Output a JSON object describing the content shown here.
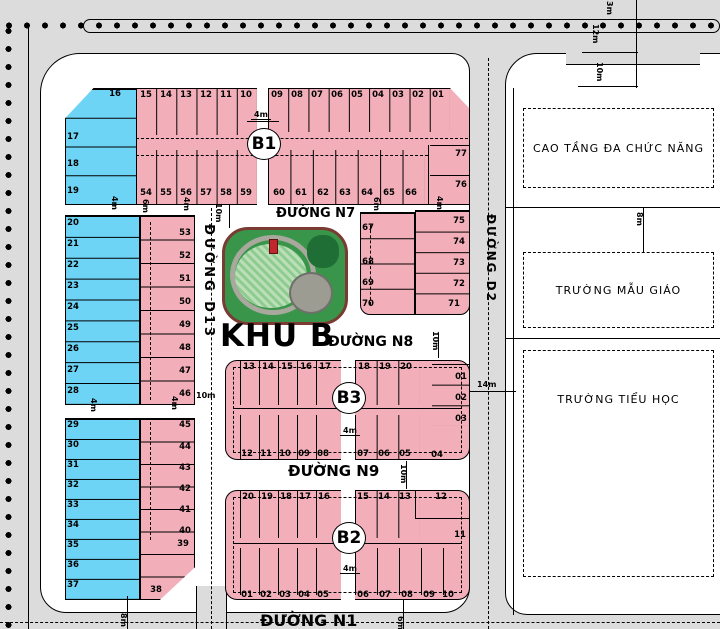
{
  "plan_title": "KHU B",
  "street_labels": {
    "n7": "ĐƯỜNG N7",
    "n8": "ĐƯỜNG N8",
    "n9": "ĐƯỜNG N9",
    "n1": "ĐƯỜNG N1",
    "d13": "ĐƯỜNG D13",
    "d2": "ĐƯỜNG D2"
  },
  "block_labels": {
    "b1": "B1",
    "b3": "B3",
    "b2": "B2"
  },
  "facility_labels": {
    "cao_tang": "CAO TẦNG ĐA CHỨC NĂNG",
    "mau_giao": "TRƯỜNG MẪU GIÁO",
    "tieu_hoc": "TRƯỜNG TIỂU HỌC"
  },
  "plan": {
    "colors": {
      "background": "#dcdcdc",
      "street_white": "#ffffff",
      "lot_pink": "#f2afba",
      "lot_blue": "#6dd4f5",
      "line": "#000000",
      "park_green": "#38954a",
      "park_border": "#7a3b32",
      "lawn_light": "#badfb8",
      "lawn_mid": "#8ecb8f",
      "plaza_gray": "#9c9c93",
      "tree_green": "#1f6e35",
      "kiosk_red": "#c1272d"
    },
    "lot_groups": [
      [
        "blue-top",
        65,
        88,
        75,
        117,
        "lot_blue",
        "v",
        4,
        {
          "border": 1,
          "clip": "polygon(0 26%, 38% 0, 100% 0, 100% 100%, 0 100%)"
        }
      ],
      [
        "b1-bg",
        136,
        88,
        334,
        117,
        "lot_pink",
        null,
        0,
        {
          "border": 1,
          "clip": "polygon(0 0, 94% 0, 100% 18%, 100% 100%, 0 100%)"
        }
      ],
      [
        "b1-strip-tl",
        136,
        88,
        121,
        47,
        null,
        "h",
        6,
        null
      ],
      [
        "b1-strip-tr",
        268,
        88,
        182,
        44,
        null,
        "h",
        9,
        null
      ],
      [
        "b1-strip-bl",
        136,
        150,
        121,
        55,
        null,
        "h",
        6,
        null
      ],
      [
        "b1-strip-br",
        268,
        150,
        157,
        55,
        null,
        "h",
        7,
        null
      ],
      [
        "b1-col-r",
        430,
        145,
        40,
        60,
        null,
        "v",
        2,
        null
      ],
      [
        "b1-alley",
        257,
        88,
        11,
        117,
        "street_white",
        null,
        0,
        null
      ],
      [
        "leftmid-blue",
        65,
        215,
        75,
        190,
        "lot_blue",
        "v",
        9,
        {
          "border": 1
        }
      ],
      [
        "leftmid-pink",
        140,
        215,
        55,
        190,
        "lot_pink",
        "v",
        8,
        {
          "border": 1
        }
      ],
      [
        "leftbot-blue",
        65,
        418,
        75,
        182,
        "lot_blue",
        "v",
        9,
        {
          "border": 1
        }
      ],
      [
        "leftbot-pink",
        140,
        418,
        55,
        182,
        "lot_pink",
        "v",
        8,
        {
          "border": 1,
          "clip": "polygon(0 0, 100% 0, 100% 82%, 36% 100%, 0 100%)"
        }
      ],
      [
        "parke-left",
        360,
        212,
        55,
        103,
        "lot_pink",
        "v",
        4,
        {
          "border": 1,
          "radius": "0 0 0 10px"
        }
      ],
      [
        "parke-right",
        415,
        210,
        55,
        105,
        "lot_pink",
        "v",
        5,
        {
          "border": 1,
          "radius": "0 0 10px 0"
        }
      ],
      [
        "b3-bg",
        225,
        360,
        245,
        100,
        "lot_pink",
        null,
        0,
        {
          "border": 1,
          "radius": "12px"
        }
      ],
      [
        "b3-tl",
        240,
        360,
        95,
        45,
        null,
        "h",
        5,
        null
      ],
      [
        "b3-tr",
        355,
        360,
        65,
        45,
        null,
        "h",
        3,
        null
      ],
      [
        "b3-bl",
        240,
        415,
        95,
        45,
        null,
        "h",
        5,
        null
      ],
      [
        "b3-br",
        355,
        415,
        65,
        45,
        null,
        "h",
        3,
        null
      ],
      [
        "b3-col",
        432,
        364,
        38,
        62,
        null,
        "v",
        3,
        null
      ],
      [
        "b3-alley",
        341,
        360,
        14,
        100,
        "street_white",
        null,
        0,
        null
      ],
      [
        "b2-bg",
        225,
        490,
        245,
        110,
        "lot_pink",
        null,
        0,
        {
          "border": 1,
          "radius": "12px"
        }
      ],
      [
        "b2-tl",
        240,
        490,
        95,
        48,
        null,
        "h",
        5,
        null
      ],
      [
        "b2-tr",
        355,
        490,
        65,
        48,
        null,
        "h",
        3,
        null
      ],
      [
        "b2-bl",
        240,
        548,
        95,
        47,
        null,
        "h",
        5,
        null
      ],
      [
        "b2-br",
        355,
        548,
        110,
        47,
        null,
        "h",
        5,
        null
      ],
      [
        "b2-alley",
        341,
        490,
        14,
        110,
        "street_white",
        null,
        0,
        null
      ]
    ],
    "lot_labels": [
      [
        "15",
        146,
        91
      ],
      [
        "14",
        166,
        91
      ],
      [
        "13",
        186,
        91
      ],
      [
        "12",
        206,
        91
      ],
      [
        "11",
        226,
        91
      ],
      [
        "10",
        246,
        91
      ],
      [
        "09",
        277,
        91
      ],
      [
        "08",
        297,
        91
      ],
      [
        "07",
        317,
        91
      ],
      [
        "06",
        337,
        91
      ],
      [
        "05",
        357,
        91
      ],
      [
        "04",
        378,
        91
      ],
      [
        "03",
        398,
        91
      ],
      [
        "02",
        418,
        91
      ],
      [
        "01",
        438,
        91
      ],
      [
        "54",
        146,
        189
      ],
      [
        "55",
        166,
        189
      ],
      [
        "56",
        186,
        189
      ],
      [
        "57",
        206,
        189
      ],
      [
        "58",
        226,
        189
      ],
      [
        "59",
        246,
        189
      ],
      [
        "60",
        279,
        189
      ],
      [
        "61",
        301,
        189
      ],
      [
        "62",
        323,
        189
      ],
      [
        "63",
        345,
        189
      ],
      [
        "64",
        367,
        189
      ],
      [
        "65",
        389,
        189
      ],
      [
        "66",
        411,
        189
      ],
      [
        "77",
        461,
        150
      ],
      [
        "76",
        461,
        181
      ],
      [
        "16",
        115,
        90
      ],
      [
        "17",
        73,
        133
      ],
      [
        "18",
        73,
        160
      ],
      [
        "19",
        73,
        187
      ],
      [
        "20",
        73,
        219
      ],
      [
        "21",
        73,
        240
      ],
      [
        "22",
        73,
        261
      ],
      [
        "23",
        73,
        282
      ],
      [
        "24",
        73,
        303
      ],
      [
        "25",
        73,
        324
      ],
      [
        "26",
        73,
        345
      ],
      [
        "27",
        73,
        366
      ],
      [
        "28",
        73,
        387
      ],
      [
        "53",
        185,
        229
      ],
      [
        "52",
        185,
        252
      ],
      [
        "51",
        185,
        275
      ],
      [
        "50",
        185,
        298
      ],
      [
        "49",
        185,
        321
      ],
      [
        "48",
        185,
        344
      ],
      [
        "47",
        185,
        367
      ],
      [
        "46",
        185,
        390
      ],
      [
        "29",
        73,
        421
      ],
      [
        "30",
        73,
        441
      ],
      [
        "31",
        73,
        461
      ],
      [
        "32",
        73,
        481
      ],
      [
        "33",
        73,
        501
      ],
      [
        "34",
        73,
        521
      ],
      [
        "35",
        73,
        541
      ],
      [
        "36",
        73,
        561
      ],
      [
        "37",
        73,
        581
      ],
      [
        "45",
        185,
        421
      ],
      [
        "44",
        185,
        443
      ],
      [
        "43",
        185,
        464
      ],
      [
        "42",
        185,
        485
      ],
      [
        "41",
        185,
        506
      ],
      [
        "40",
        185,
        527
      ],
      [
        "39",
        183,
        540
      ],
      [
        "38",
        156,
        586
      ],
      [
        "67",
        368,
        224
      ],
      [
        "68",
        368,
        258
      ],
      [
        "69",
        368,
        279
      ],
      [
        "70",
        368,
        300
      ],
      [
        "75",
        459,
        217
      ],
      [
        "74",
        459,
        238
      ],
      [
        "73",
        459,
        259
      ],
      [
        "72",
        459,
        280
      ],
      [
        "71",
        454,
        300
      ],
      [
        "13",
        249,
        363
      ],
      [
        "14",
        268,
        363
      ],
      [
        "15",
        287,
        363
      ],
      [
        "16",
        306,
        363
      ],
      [
        "17",
        325,
        363
      ],
      [
        "18",
        364,
        363
      ],
      [
        "19",
        385,
        363
      ],
      [
        "20",
        406,
        363
      ],
      [
        "01",
        461,
        373
      ],
      [
        "02",
        461,
        394
      ],
      [
        "03",
        461,
        415
      ],
      [
        "04",
        437,
        451
      ],
      [
        "12",
        247,
        450
      ],
      [
        "11",
        266,
        450
      ],
      [
        "10",
        285,
        450
      ],
      [
        "09",
        304,
        450
      ],
      [
        "08",
        323,
        450
      ],
      [
        "07",
        363,
        450
      ],
      [
        "06",
        384,
        450
      ],
      [
        "05",
        405,
        450
      ],
      [
        "20",
        248,
        493
      ],
      [
        "19",
        267,
        493
      ],
      [
        "18",
        286,
        493
      ],
      [
        "17",
        305,
        493
      ],
      [
        "16",
        324,
        493
      ],
      [
        "15",
        363,
        493
      ],
      [
        "14",
        384,
        493
      ],
      [
        "13",
        405,
        493
      ],
      [
        "12",
        441,
        493
      ],
      [
        "11",
        460,
        531
      ],
      [
        "01",
        247,
        591
      ],
      [
        "02",
        266,
        591
      ],
      [
        "03",
        285,
        591
      ],
      [
        "04",
        304,
        591
      ],
      [
        "05",
        323,
        591
      ],
      [
        "06",
        363,
        591
      ],
      [
        "07",
        385,
        591
      ],
      [
        "08",
        407,
        591
      ],
      [
        "09",
        429,
        591
      ],
      [
        "10",
        448,
        591
      ]
    ],
    "dim_labels": [
      [
        "4m",
        251,
        110,
        0,
        true
      ],
      [
        "4m",
        109,
        196,
        90,
        false
      ],
      [
        "6m",
        140,
        199,
        90,
        false
      ],
      [
        "4m",
        181,
        197,
        90,
        false
      ],
      [
        "10m",
        213,
        203,
        90,
        false
      ],
      [
        "6m",
        371,
        197,
        90,
        false
      ],
      [
        "4m",
        434,
        196,
        90,
        false
      ],
      [
        "4m",
        88,
        398,
        90,
        false
      ],
      [
        "4m",
        169,
        396,
        90,
        false
      ],
      [
        "10m",
        196,
        391,
        0,
        false
      ],
      [
        "10m",
        430,
        331,
        90,
        false
      ],
      [
        "10m",
        398,
        464,
        90,
        false
      ],
      [
        "4m",
        340,
        426,
        0,
        true
      ],
      [
        "4m",
        340,
        564,
        0,
        true
      ],
      [
        "14m",
        477,
        380,
        0,
        false
      ],
      [
        "8m",
        634,
        212,
        90,
        false
      ],
      [
        "12m",
        590,
        24,
        90,
        false
      ],
      [
        "10m",
        594,
        62,
        90,
        false
      ],
      [
        "3m",
        604,
        1,
        90,
        false
      ],
      [
        "6m",
        395,
        616,
        90,
        false
      ],
      [
        "8m",
        118,
        613,
        90,
        false
      ]
    ]
  }
}
